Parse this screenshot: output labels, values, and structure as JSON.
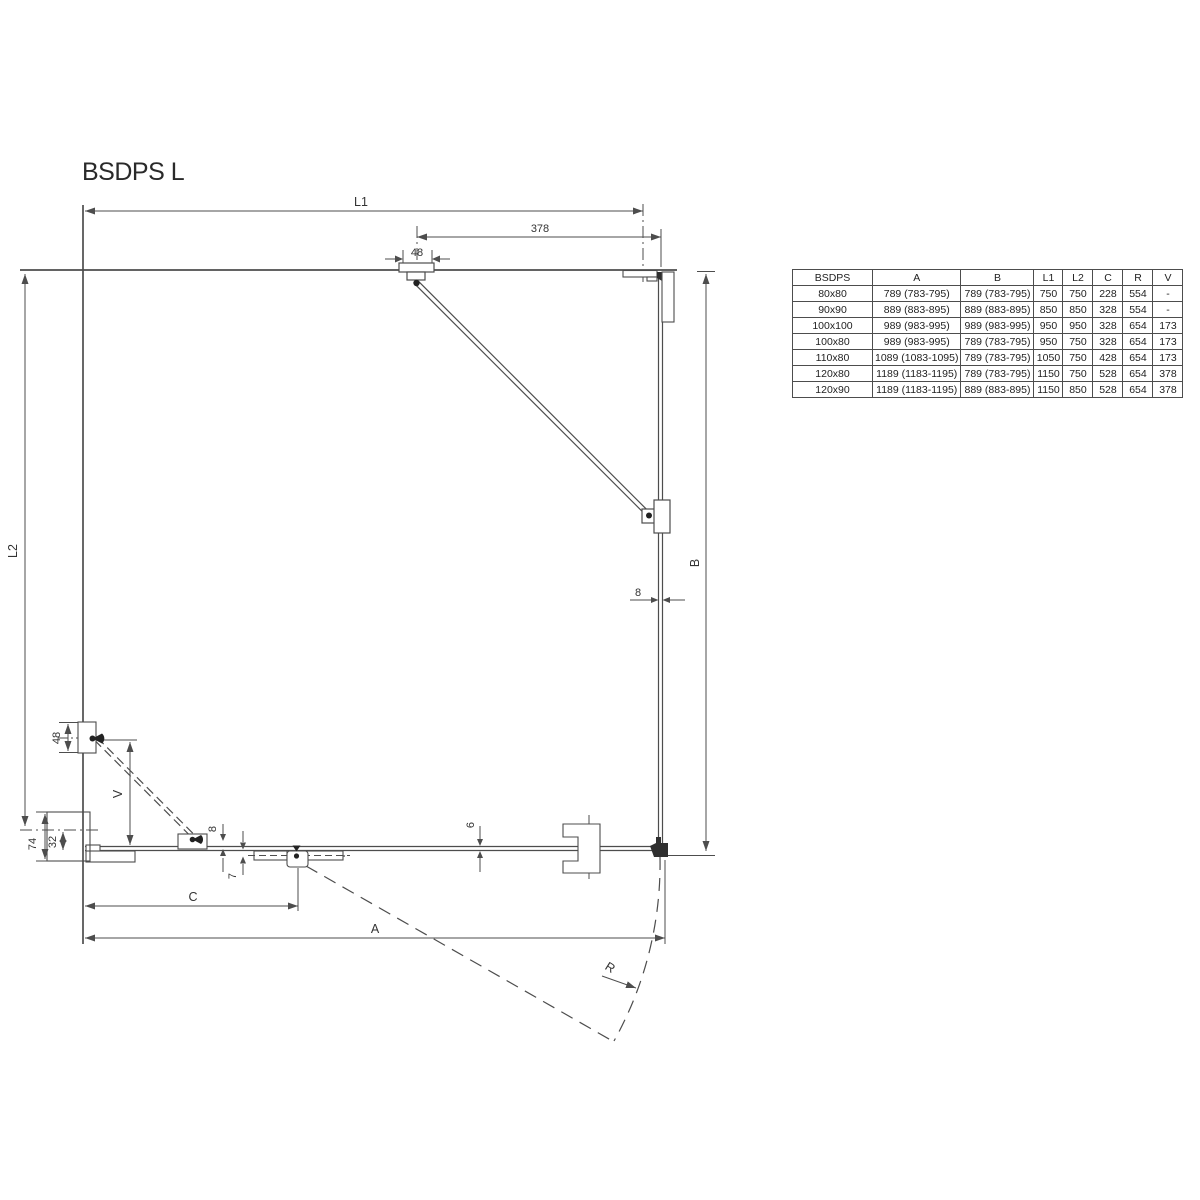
{
  "title": "BSDPS L",
  "table": {
    "headers": [
      "BSDPS",
      "A",
      "B",
      "L1",
      "L2",
      "C",
      "R",
      "V"
    ],
    "rows": [
      [
        "80x80",
        "789 (783-795)",
        "789 (783-795)",
        "750",
        "750",
        "228",
        "554",
        "-"
      ],
      [
        "90x90",
        "889 (883-895)",
        "889 (883-895)",
        "850",
        "850",
        "328",
        "554",
        "-"
      ],
      [
        "100x100",
        "989 (983-995)",
        "989 (983-995)",
        "950",
        "950",
        "328",
        "654",
        "173"
      ],
      [
        "100x80",
        "989 (983-995)",
        "789 (783-795)",
        "950",
        "750",
        "328",
        "654",
        "173"
      ],
      [
        "110x80",
        "1089 (1083-1095)",
        "789 (783-795)",
        "1050",
        "750",
        "428",
        "654",
        "173"
      ],
      [
        "120x80",
        "1189 (1183-1195)",
        "789 (783-795)",
        "1150",
        "750",
        "528",
        "654",
        "378"
      ],
      [
        "120x90",
        "1189 (1183-1195)",
        "889 (883-895)",
        "1150",
        "850",
        "528",
        "654",
        "378"
      ]
    ]
  },
  "drawing_labels": {
    "L1": "L1",
    "dim_378": "378",
    "dim_48_top": "48",
    "L2": "L2",
    "B": "B",
    "dim_8_panel": "8",
    "dim_48_wall": "48",
    "V": "V",
    "dim_74": "74",
    "dim_32": "32",
    "dim_8_door": "8",
    "dim_7": "7",
    "dim_6": "6",
    "C": "C",
    "A": "A",
    "R": "R"
  },
  "colors": {
    "line": "#4d4d4d",
    "text": "#333333",
    "background": "#ffffff"
  }
}
